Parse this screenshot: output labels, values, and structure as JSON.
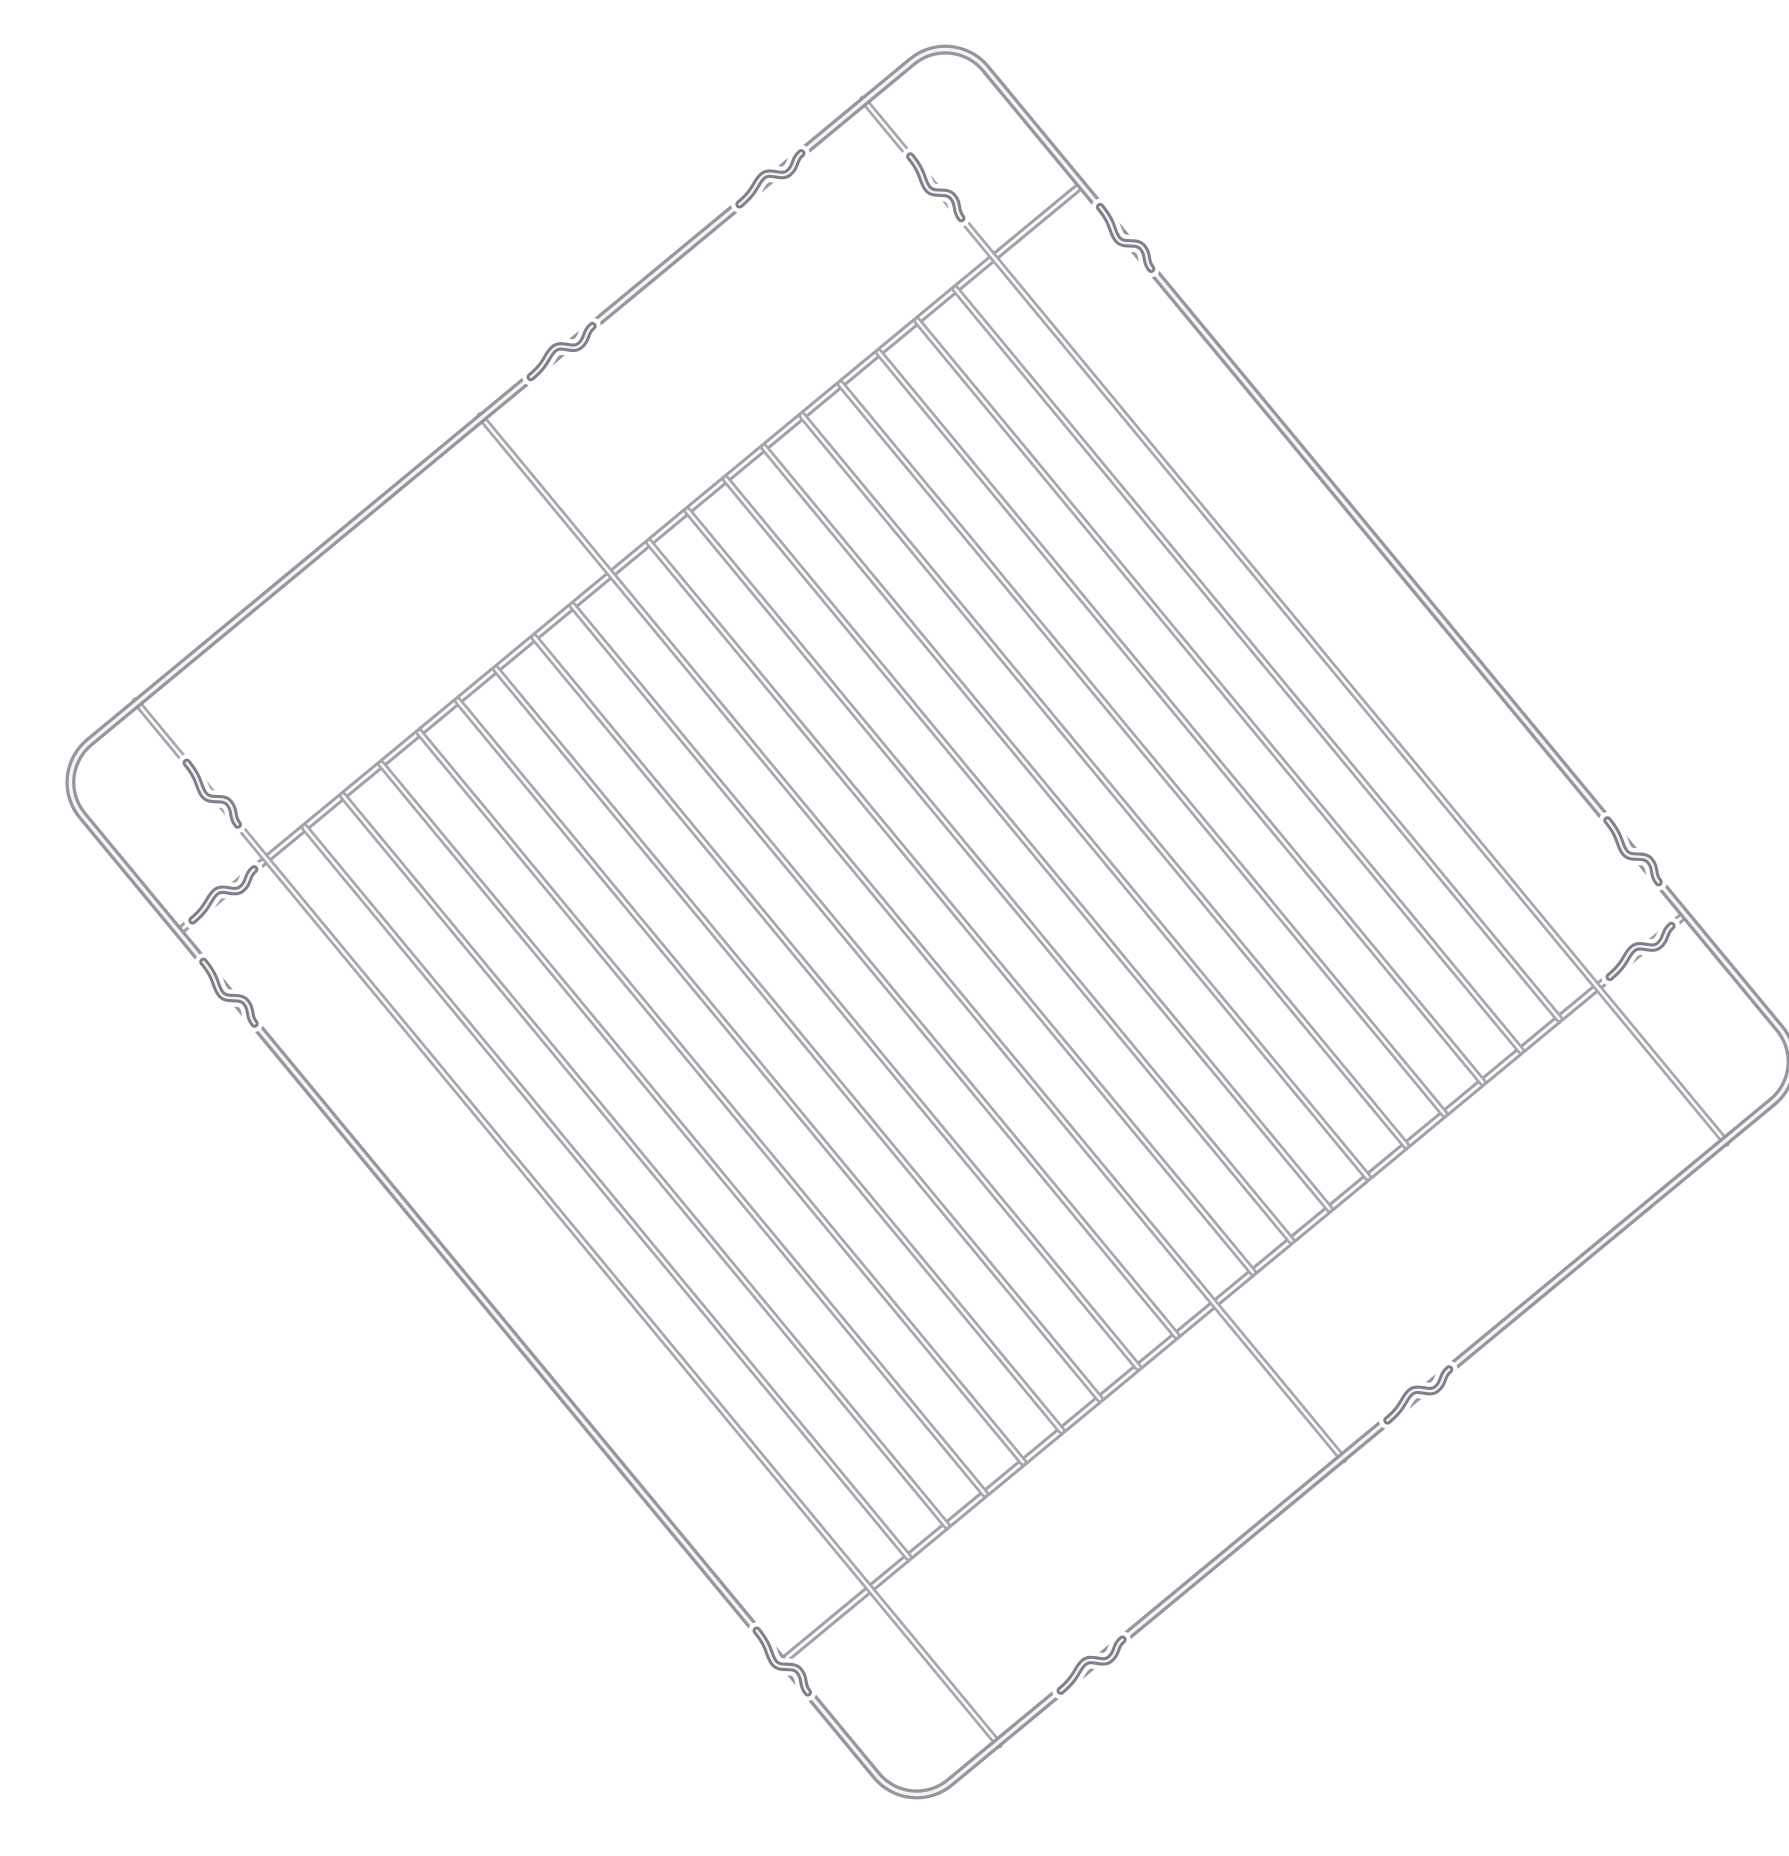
{
  "page": {
    "background_color": "#ffffff",
    "alt_text": "Chrome-plated wire oven grill rack shown diagonally rotated on a plain white background"
  },
  "rack": {
    "object": "oven-grill-wire-rack",
    "colors": {
      "background": "#ffffff",
      "wire_base": "#a6a6ad",
      "wire_highlight": "#fbfbfd",
      "frame_base": "#96969e",
      "frame_highlight": "#f4f4f7",
      "bar_base": "#a0a0a8",
      "kink_shade": "#80808a"
    },
    "canvas": {
      "width": 1789,
      "height": 1824
    },
    "placement": {
      "center_x": 891,
      "center_y": 906,
      "rotation_deg": -39.6
    },
    "frame": {
      "width": 1172,
      "height": 1350,
      "corner_radius": 52,
      "stroke_width": 10,
      "highlight_width": 3.4
    },
    "cross_bars": {
      "count": 2,
      "top_y": 203,
      "bottom_y": 1150,
      "stroke_width": 9,
      "highlight_width": 3
    },
    "grid_wires": {
      "count": 20,
      "first_x": 114,
      "last_x": 1058,
      "stroke_width": 8,
      "highlight_width": 2.6,
      "full_length_indices": [
        0,
        9,
        19
      ],
      "full_overhang": 2
    },
    "kinks": {
      "half_length": 40,
      "amplitude": 7,
      "items": [
        {
          "x": 936,
          "y": 0,
          "axis": "h",
          "part": "frame-top-edge"
        },
        {
          "x": 665,
          "y": 0,
          "axis": "h",
          "part": "frame-top-edge"
        },
        {
          "x": 236,
          "y": 1350,
          "axis": "h",
          "part": "frame-bottom-edge"
        },
        {
          "x": 660,
          "y": 1350,
          "axis": "h",
          "part": "frame-bottom-edge"
        },
        {
          "x": 1172,
          "y": 272,
          "axis": "v",
          "part": "frame-right-edge"
        },
        {
          "x": 1172,
          "y": 1068,
          "axis": "v",
          "part": "frame-right-edge"
        },
        {
          "x": 0,
          "y": 282,
          "axis": "v",
          "part": "frame-left-edge"
        },
        {
          "x": 0,
          "y": 1150,
          "axis": "v",
          "part": "frame-left-edge"
        },
        {
          "x": 58,
          "y": 203,
          "axis": "h",
          "part": "cross-bar-top"
        },
        {
          "x": 1114,
          "y": 1150,
          "axis": "h",
          "part": "cross-bar-bottom"
        },
        {
          "x": 1058,
          "y": 112,
          "axis": "v",
          "part": "grid-wire-first"
        },
        {
          "x": 114,
          "y": 118,
          "axis": "v",
          "part": "grid-wire-last"
        }
      ]
    }
  }
}
